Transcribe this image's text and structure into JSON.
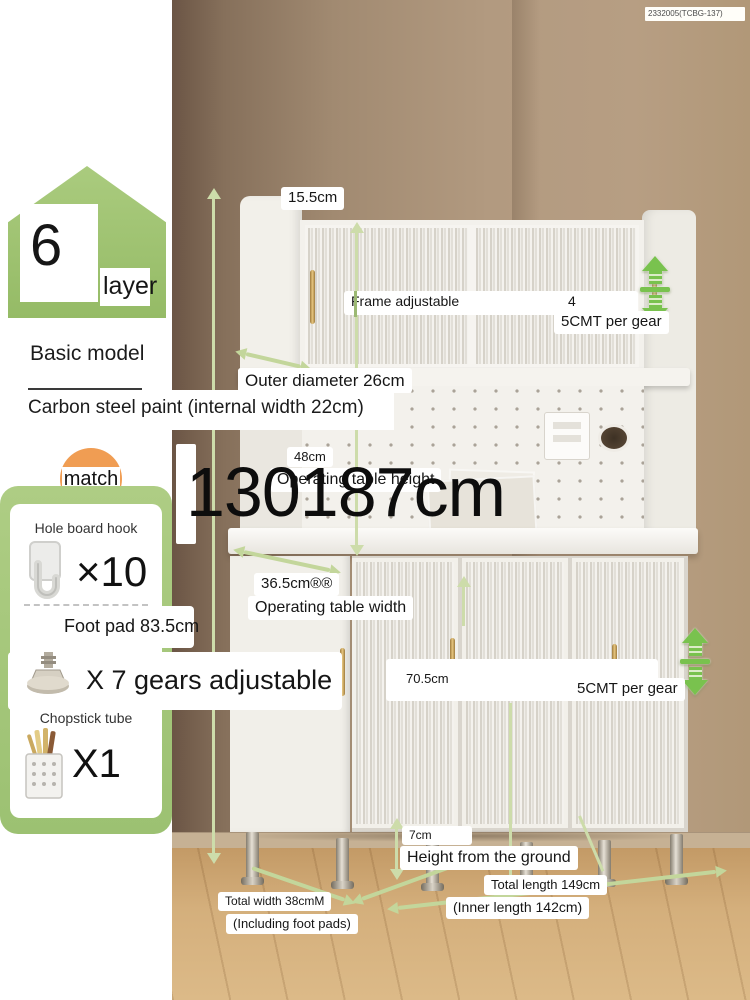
{
  "product_code": "2332005(TCBG-137)",
  "layer_badge": {
    "number": "6",
    "label": "layer"
  },
  "model": {
    "name": "Basic model",
    "material": "Carbon steel paint (internal width 22cm)"
  },
  "match": {
    "badge": "match",
    "items": [
      {
        "name": "Hole board hook",
        "qty": "×10"
      },
      {
        "name": "Foot pad 83.5cm",
        "qty": "X 7 gears adjustable"
      },
      {
        "name": "Chopstick tube",
        "qty": "X1"
      }
    ]
  },
  "dimensions": {
    "overall_size": "130187cm",
    "top_depth": "15.5cm",
    "frame_adjustable_label": "Frame adjustable",
    "frame_adjustable_value": "4",
    "gear_note_top": "5CMT per gear",
    "outer_diameter": "Outer diameter 26cm",
    "table_height_value": "48cm",
    "table_height_label": "Operating table height",
    "table_width_value": "36.5cm®®",
    "table_width_label": "Operating table width",
    "cabinet_inner_height": "70.5cm",
    "gear_note_bottom": "5CMT per gear",
    "ground_clearance_value": "7cm",
    "ground_clearance_label": "Height from the ground",
    "total_width": "Total width 38cmM",
    "total_width_note": "(Including foot pads)",
    "total_length": "Total length 149cm",
    "total_length_note": "(Inner length 142cm)"
  },
  "colors": {
    "accent_green": "#79c24e",
    "line_green": "#cddcaa",
    "badge_green": "#a3c878",
    "badge_orange": "#f09d53",
    "label_bg": "#ffffff"
  }
}
